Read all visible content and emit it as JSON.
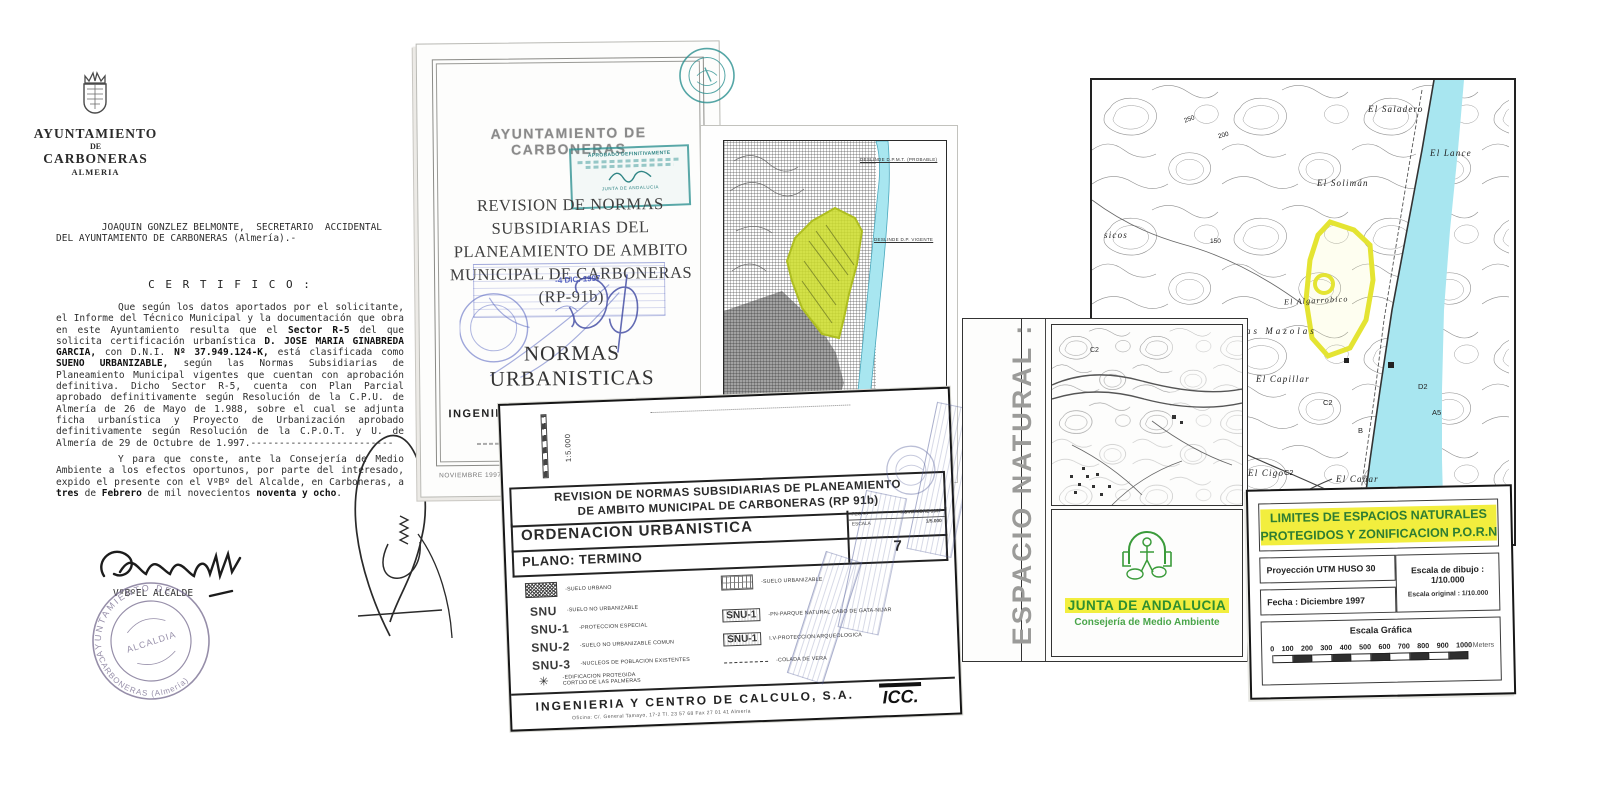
{
  "colors": {
    "yellow_highlight": "#f2ee3e",
    "green_text": "#2e7d32",
    "zone_chartreuse": "#c9d835",
    "sea_cyan": "#a8e6f0",
    "stamp_teal": "#2a9090",
    "stamp_blue": "#5b6cc0"
  },
  "certificate": {
    "org_line1": "AYUNTAMIENTO",
    "org_line2": "DE",
    "org_line3": "CARBONERAS",
    "org_line4": "ALMERIA",
    "intro": "        JOAQUIN GONZLEZ BELMONTE,  SECRETARIO  ACCIDENTAL\nDEL AYUNTAMIENTO DE CARBONERAS (Almería).-",
    "certifico": "C E R T I F I C O :",
    "body1": [
      {
        "t": "Que según los datos aportados por el solicitante, el Informe del Técnico Municipal y la documentación que obra en este Ayuntamiento resulta que el "
      },
      {
        "t": "Sector R-5"
      },
      {
        "t": " del que solicita certificación urbanística "
      },
      {
        "t": "D. JOSE MARIA GINABREDA GARCIA,"
      },
      {
        "t": " con D.N.I. "
      },
      {
        "t": "Nº 37.949.124-K,"
      },
      {
        "t": " está clasificada como "
      },
      {
        "t": "SUENO URBANIZABLE,"
      },
      {
        "t": " según las Normas Subsidiarias de Planeamiento Municipal vigentes que cuentan con aprobación definitiva. Dicho Sector R-5, cuenta con Plan Parcial aprobado definitivamente según Resolución de la C.P.U. de Almería de 26 de Mayo de 1.988, sobre el cual se adjunta ficha urbanística y Proyecto de Urbanización aprobado definitivamente según Resolución de la C.P.O.T. y U. de Almería de 29 de Octubre de 1.997.-------------------------"
      }
    ],
    "body2": [
      {
        "t": "Y para que conste, ante la Consejería de Medio Ambiente a los efectos oportunos, por parte del interesado, expido el presente con el VºBº del Alcalde, en Carboneras, a "
      },
      {
        "t": "tres"
      },
      {
        "t": " de "
      },
      {
        "t": "Febrero"
      },
      {
        "t": " de mil novecientos "
      },
      {
        "t": "noventa y ocho"
      },
      {
        "t": "."
      }
    ],
    "vobo": "VºBºEL  ALCALDE",
    "stamp_top": "AYUNTAMIENTO DE",
    "stamp_bottom": "CARBONERAS (Almería)",
    "stamp_center": "ALCALDIA"
  },
  "title_page": {
    "header": "AYUNTAMIENTO DE CARBONERAS",
    "title": "REVISION DE NORMAS SUBSIDIARIAS DEL PLANEAMIENTO DE AMBITO MUNICIPAL DE CARBONERAS (RP-91b)",
    "subtitle": "NORMAS URBANISTICAS",
    "approval_stamp_line": "APROBADO DEFINITIVAMENTE",
    "approval_stamp_sub": "JUNTA DE ANDALUCIA",
    "date_stamp": "-4 DIC. 1997",
    "firm": "INGENIERIA Y CENTRO DE CALCULO, S.A.",
    "firm_logo": "ICC.",
    "footer_date": "NOVIEMBRE 1997"
  },
  "map_fragment": {
    "annotation_top": "DESLINDE D.P.M.T. (PROBABLE)",
    "annotation_mid": "DESLINDE D.P. VIGENTE",
    "annotation_bottom": "DESLINDE D.P.M.T. (PROBABLE)",
    "zone_label": "(2)"
  },
  "plan_sheet": {
    "scale_vertical": "1:5.000",
    "title": "REVISION DE NORMAS SUBSIDIARIAS DE PLANEAMIENTO\nDE AMBITO MUNICIPAL DE CARBONERAS (RP 91b)",
    "row2_left": "ORDENACION URBANISTICA",
    "fecha_label": "FECHA",
    "fecha_value": "NOVIEMBRE 1997",
    "escala_label": "ESCALA",
    "escala_value": "1/5.000",
    "row3_left": "PLANO: TERMINO",
    "sheet_number": "7",
    "legend_left": [
      {
        "code": "",
        "label": "-SUELO URBANO"
      },
      {
        "code": "SNU",
        "label": "-SUELO NO URBANIZABLE"
      },
      {
        "code": "SNU-1",
        "label": "-PROTECCION ESPECIAL"
      },
      {
        "code": "SNU-2",
        "label": "-SUELO NO URBANIZABLE COMUN"
      },
      {
        "code": "SNU-3",
        "label": "-NUCLEOS DE POBLACION EXISTENTES"
      },
      {
        "code": "✳",
        "label": "-EDIFICACION PROTEGIDA\nCORTIJO DE LAS PALMERAS"
      }
    ],
    "legend_right": [
      {
        "code": "",
        "label": "-SUELO URBANIZABLE"
      },
      {
        "code": "SNU-1",
        "label": "-PN-PARQUE NATURAL CABO DE GATA-NIJAR"
      },
      {
        "code": "SNU-1",
        "label": "I.V-PROTECCION ARQUEOLOGICA"
      },
      {
        "code": "",
        "label": "-COLADA DE VERA"
      }
    ],
    "firm": "INGENIERIA Y CENTRO DE CALCULO, S.A.",
    "firm_logo": "ICC.",
    "firm_address": "Oficina: C/. General Tamayo, 17-2   Tl. 23 57 68   Fax 27 01 41   Almería"
  },
  "espacio_panel": {
    "vertical_label": "ESPACIO NATURAL :",
    "map_code": "C2",
    "junta": "JUNTA DE ANDALUCIA",
    "consejeria": "Consejería de Medio Ambiente"
  },
  "topo_map": {
    "labels": [
      "El Saladero",
      "El Lance",
      "El Solimán",
      "sicos",
      "El Algarrobico",
      "Las Mazolas",
      "El Capillar",
      "El Cigo",
      "El Cañar",
      "D2",
      "A5",
      "C2",
      "C2",
      "B",
      "150",
      "250",
      "200",
      "100"
    ]
  },
  "limites_block": {
    "title": "LIMITES DE ESPACIOS NATURALES\nPROTEGIDOS Y ZONIFICACION P.O.R.N",
    "proyeccion": "Proyección UTM HUSO 30",
    "fecha": "Fecha : Diciembre 1997",
    "escala_dibujo": "Escala de dibujo : 1/10.000",
    "escala_original": "Escala original : 1/10.000",
    "escala_grafica": "Escala Gráfica",
    "scale_ticks": [
      "0",
      "100",
      "200",
      "300",
      "400",
      "500",
      "600",
      "700",
      "800",
      "900",
      "1000"
    ],
    "scale_unit": "Meters"
  }
}
